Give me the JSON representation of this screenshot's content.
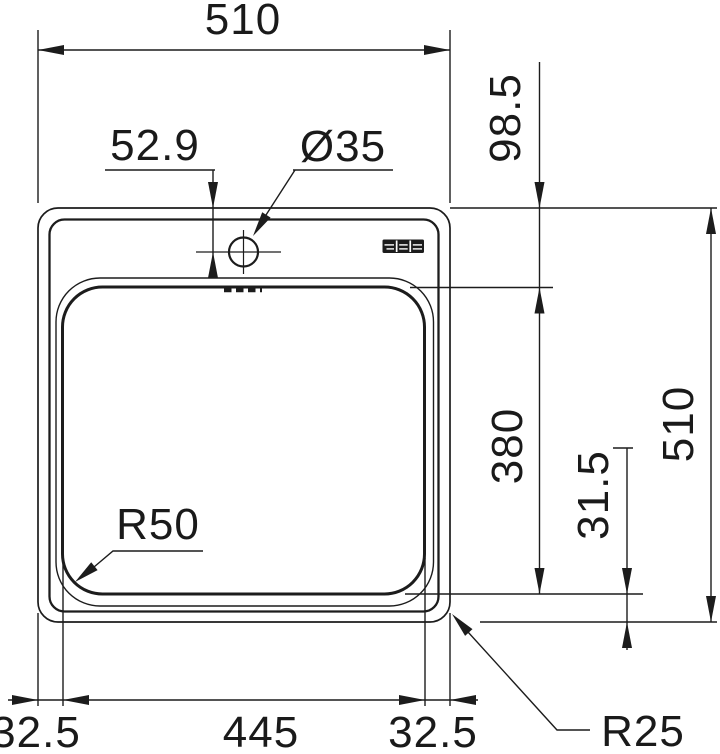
{
  "colors": {
    "line": "#1c1c1c",
    "text": "#1a1a1a",
    "background": "#ffffff"
  },
  "icons": {
    "brand_mark": "franke-triple-block-logo"
  },
  "drawing": {
    "labels": {
      "overall_width_top": "510",
      "tap_hole_offset": "52.9",
      "tap_hole_diameter": "Ø35",
      "deck_depth": "98.5",
      "bowl_length": "380",
      "overall_depth_right": "510",
      "bowl_edge_gap": "31.5",
      "bowl_corner_radius": "R50",
      "outer_corner_radius": "R25",
      "bottom_left_margin": "32.5",
      "bowl_width": "445",
      "bottom_right_margin": "32.5"
    }
  }
}
